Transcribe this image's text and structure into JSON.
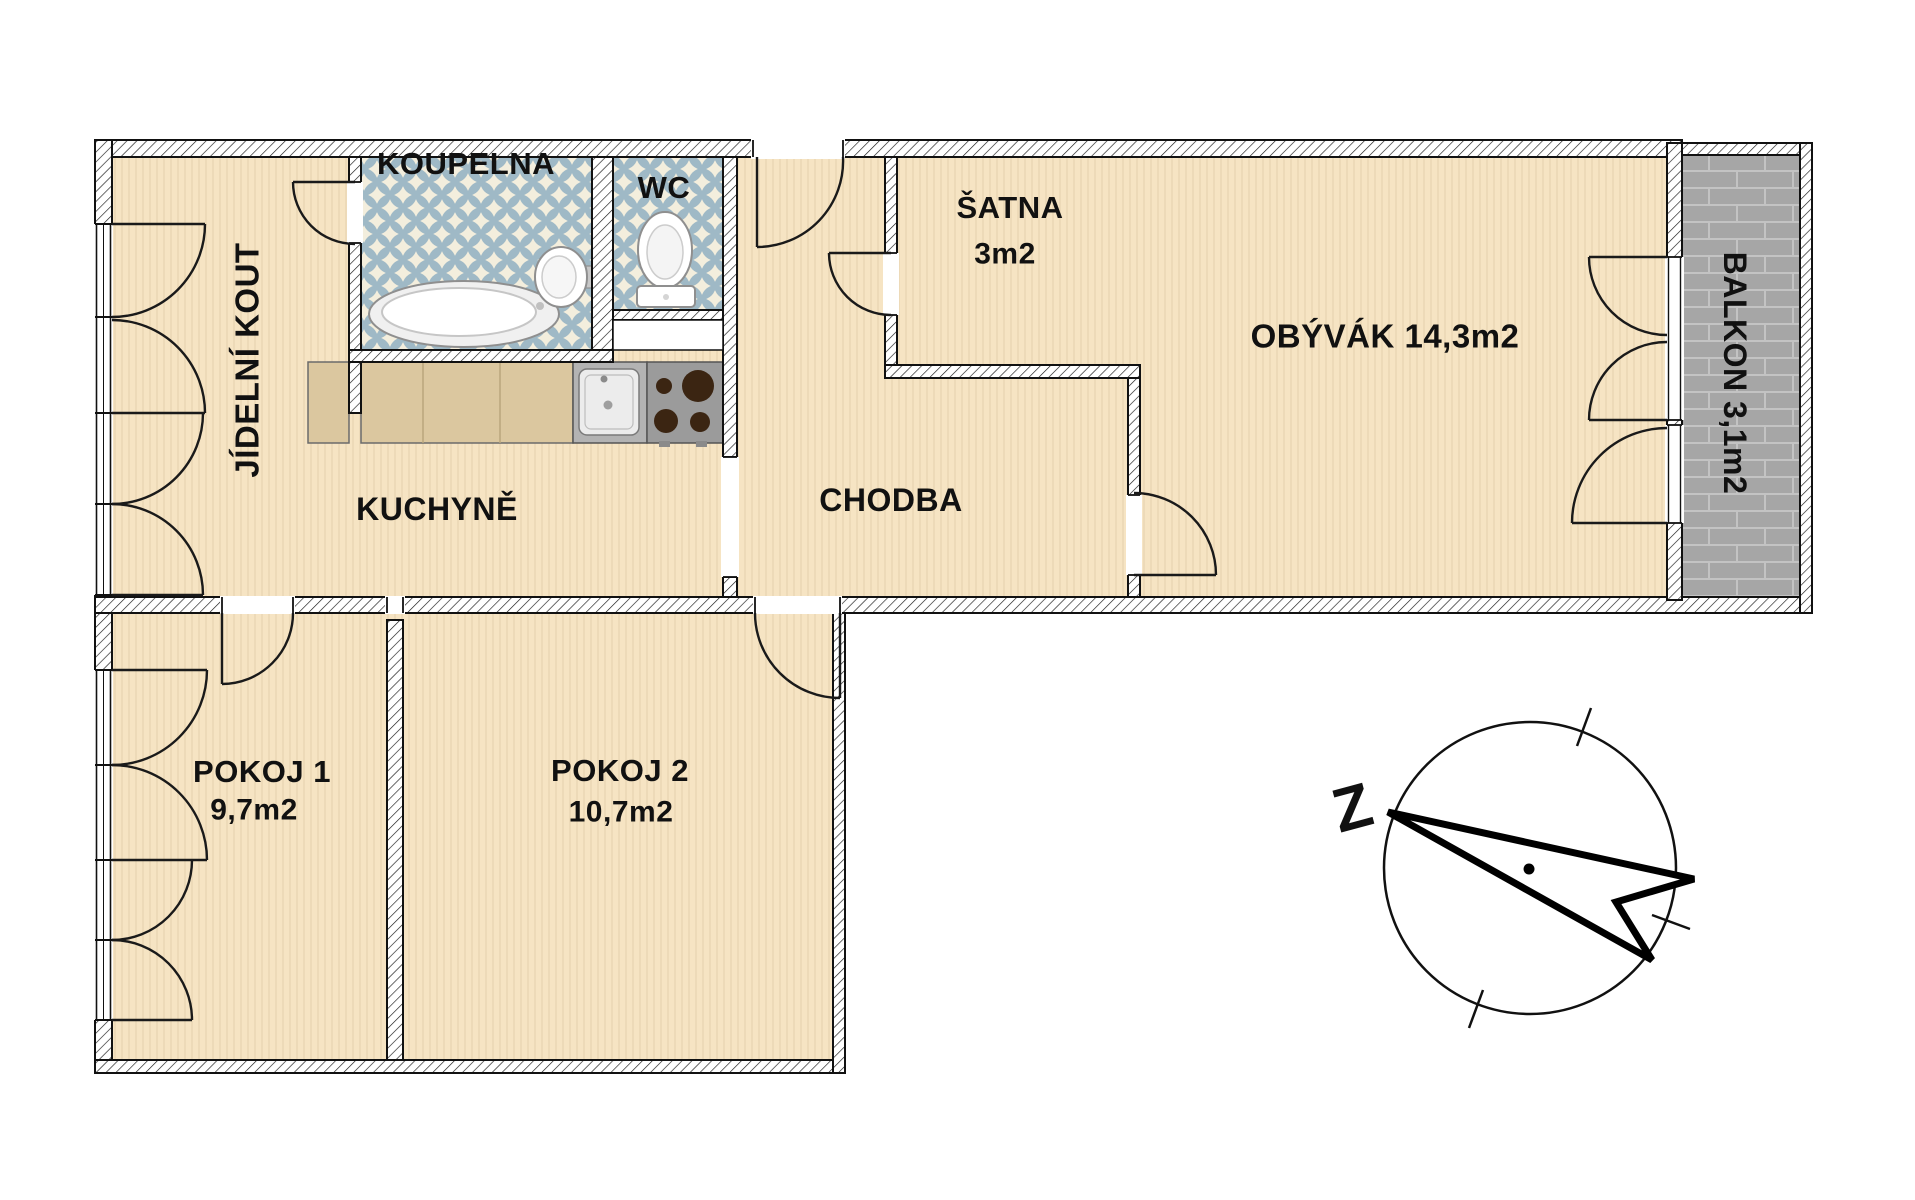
{
  "plan": {
    "rooms": {
      "jidelni_kout": {
        "label": "JÍDELNÍ KOUT"
      },
      "koupelna": {
        "label": "KOUPELNA"
      },
      "wc": {
        "label": "WC"
      },
      "satna": {
        "label": "ŠATNA",
        "area": "3m2"
      },
      "obyvak": {
        "label": "OBÝVÁK 14,3m2"
      },
      "balkon": {
        "label": "BALKON  3,1m2"
      },
      "kuchyne": {
        "label": "KUCHYNĚ"
      },
      "chodba": {
        "label": "CHODBA"
      },
      "pokoj1": {
        "label": "POKOJ 1",
        "area": "9,7m2"
      },
      "pokoj2": {
        "label": "POKOJ 2",
        "area": "10,7m2"
      }
    },
    "compass": {
      "north_label": "Z"
    },
    "colors": {
      "floor": "#f6e4c3",
      "wall_fill": "#ffffff",
      "wall_line": "#111111",
      "bath_tile": "#9fb9c6",
      "bath_tile_bg": "#f3eedd",
      "balcony_paver": "#a6a6a6",
      "balcony_grout": "#c3c3c3",
      "counter_marble": "#dbc79f",
      "appliance_gray": "#9b9b9b",
      "burner_brown": "#3b2512"
    }
  }
}
